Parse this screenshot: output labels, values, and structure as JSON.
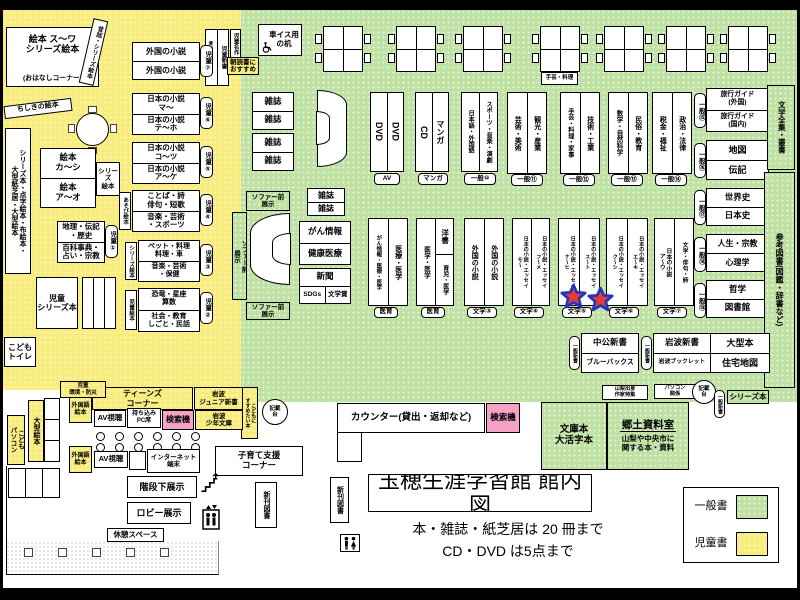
{
  "colors": {
    "children_area": "#F7EC7D",
    "general_area": "#BFE2A4",
    "search_machine": "#F4A2C6",
    "star_fill": "#E23C36",
    "star_border": "#2335C0"
  },
  "title": {
    "main": "玉穂生涯学習館 館内図",
    "limit_books": "本・雑誌・紙芝居は 20 冊まで",
    "limit_av": "CD・DVD は5点まで"
  },
  "legend": {
    "general": "一般書",
    "children": "児童書"
  },
  "kids": {
    "ohanashi_top": "絵本 ス〜ワ\nシリーズ絵本",
    "ohanashi_bottom": "(おはなしコーナー)",
    "mukashi": "昔話・シリーズ絵本",
    "chishiki": "ちしきの絵本",
    "series_stack": "シリーズ本・点字絵本・布絵本・\n大型紙芝居・大型絵本",
    "ehon_ka": "絵本\nカ〜シ",
    "ehon_a": "絵本\nア〜オ",
    "series_ehon": "シリーズ\n絵本",
    "chiri": "地理・伝記\n・歴史",
    "hyakka": "百科事典・\n占い・宗教",
    "jido_series": "児童\nシリーズ本",
    "toilet": "こども\nトイレ",
    "gaikoku_novel": "外国の小説",
    "nihon_ma": "日本の小説\nマ〜",
    "nihon_te": "日本の小説\nテ〜ホ",
    "nihon_ko": "日本の小説\nコ〜ツ",
    "nihon_a": "日本の小説\nア〜ケ",
    "kotoba": "ことば・詩\n俳句・短歌",
    "ongaku_sp": "音楽・芸術\n・スポーツ",
    "pet": "ペット・料理\n料理・車",
    "ongaku_hoken": "音楽・芸術\n・保健",
    "kyoryu": "恐竜・星座\n算数",
    "shakai": "社会・教育\nしごと・民話",
    "asobi": "あそび絵本",
    "series_ehon_v": "シリーズ絵本",
    "jido_ehon_v": "児童絵本",
    "tags": {
      "t1": "児童①",
      "t2": "児童②",
      "t3": "児童③",
      "t4": "児童④",
      "t5": "児童⑤",
      "t6": "児童⑥",
      "t7": "児童⑦"
    },
    "aoitori": "青い鳥文庫・他",
    "jido_shinsho": "児童新書",
    "jido_meisaku": "児童名作",
    "asadoku": "朝読書に\nおすすめ",
    "kankyo": "児童\n環境・防災",
    "ogata_ehon": "大型絵本",
    "kodomo_pc": "こども\nパソコン",
    "gaikokugo_ehon": "外国語\n絵本",
    "susume": "こどもに\nすすめたい本"
  },
  "general": {
    "kurumaisu": "車イス用\nの机",
    "zasshi": "雑誌",
    "sofa_mae": "ソファー前\n展示",
    "dvd": "DVD",
    "cd": "CD",
    "manga": "マンガ",
    "nihongo": "日本語・外国語",
    "sports": "スポーツ・音楽・演劇",
    "geijutsu": "芸術・美術",
    "kanko": "観光・産業",
    "shugei": "手芸・料理・家事",
    "gijutsu": "技術・工業",
    "shugei_note": "手芸・料理",
    "sugaku": "数学・自然科学",
    "minzoku": "民俗・教育",
    "zeikin": "税金・福祉",
    "seiji": "政治・法律",
    "ryoko_f": "旅行ガイド\n(外国)",
    "ryoko_d": "旅行ガイド\n(国内)",
    "chizu": "地図",
    "denki": "伝記",
    "sekaishi": "世界史",
    "nihonshi": "日本史",
    "jinsei": "人生・宗教",
    "shinri": "心理学",
    "tetsugaku": "哲学",
    "toshokan": "図書館",
    "zenshu": "文学全集・叢書",
    "sanko": "参考図書(図鑑・辞書など)",
    "gan": "がん情報",
    "kenko": "健康医療",
    "shinbun": "新聞",
    "sdgs": "SDGs",
    "bungakusho": "文学賞",
    "gan_shelf": "がん情報・医療・医学",
    "iryo": "医療・医学",
    "igaku": "医学・医学",
    "yosho": "洋書",
    "ikuji": "育児・医学",
    "gaikoku_novel": "外国の小説",
    "jae_mo": "日本の小説・エッセイ\nモ〜",
    "jae_fu": "日本の小説・エッセイ\nフ〜メ",
    "jae_na": "日本の小説・エッセイ\nナ〜ヒ",
    "jae_su": "日本の小説・エッセイ\nス〜ト",
    "jae_ku": "日本の小説・エッセイ\nク〜シ",
    "jae_e": "日本の小説・エッセイ\nエ〜キ",
    "jae_a": "日本の小説\nア〜ウ",
    "bungaku_haiku": "文学・俳句・詩",
    "tags": {
      "av": "AV",
      "manga": "マンガ",
      "t10": "一般⑩",
      "t11": "一般⑪",
      "t12": "一般⑫",
      "t13": "一般⑬",
      "t14": "一般⑭",
      "t15": "一般⑮",
      "t16": "一般⑯",
      "t17": "一般⑰",
      "t18": "一般⑱",
      "t19": "一般⑲",
      "iiku": "医育",
      "b3": "文学③",
      "b4": "文学④",
      "b5": "文学⑤",
      "b6": "文学⑥",
      "b7": "文学⑦",
      "shinsho": "一般新書"
    },
    "chuko": "中公新書",
    "bluebacks": "ブルーバックス",
    "iwanami_s": "岩波新書",
    "iwanami_b": "岩波ブックレット",
    "ogata_bon": "大型本",
    "jutaku": "住宅地図",
    "yamanashi": "山梨出身\n作家特集",
    "pc": "パソコン\n関係",
    "kisaidai": "記載\n台",
    "series_bon": "シリーズ本",
    "bunko": "文庫本\n大活字本",
    "kyodo": "郷土資料室",
    "kyodo_desc": "山梨や中央市に\n関する本・資料"
  },
  "service": {
    "counter": "カウンター(貸出・返却など)",
    "kensakuki": "検索機",
    "shinkan": "新刊図書"
  },
  "teens": {
    "corner": "ティーンズ\nコーナー",
    "iwanami_jr": "岩波\nジュニア新書",
    "iwanami_sh": "岩波\n少年文庫",
    "av": "AV視聴",
    "pc_seat": "持ち込み\nPC席",
    "internet": "インターネット\n端末",
    "kosodate": "子育て支援\nコーナー",
    "kaidan": "階段下展示",
    "lobby": "ロビー展示",
    "kyukei": "休憩スペース"
  }
}
